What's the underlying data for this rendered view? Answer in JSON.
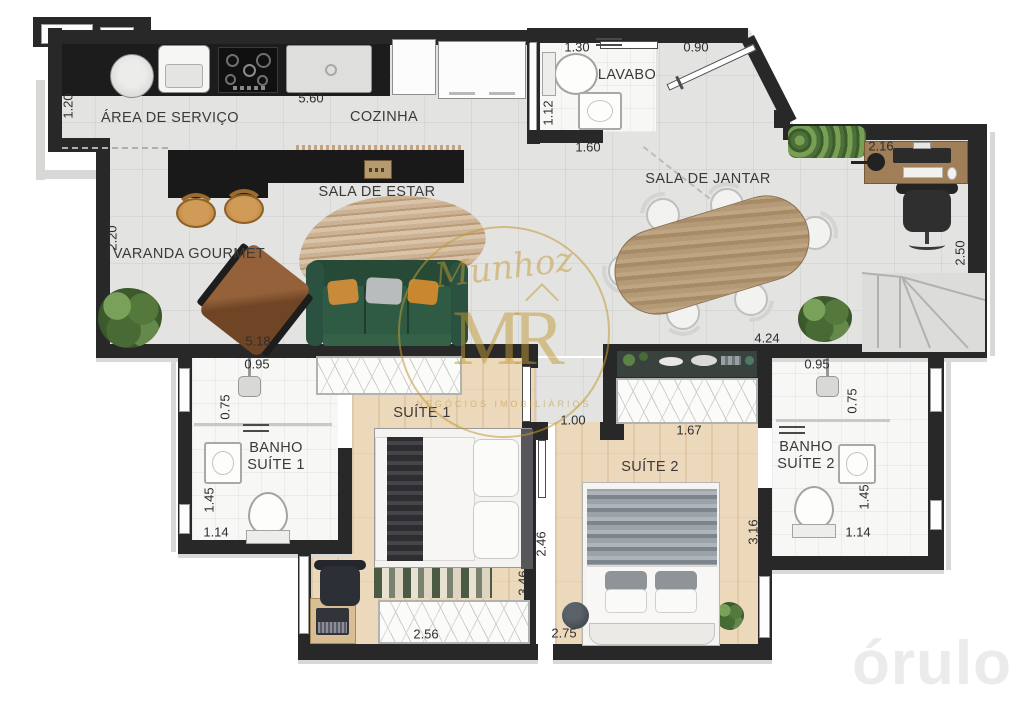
{
  "rooms": {
    "servico": "ÁREA DE SERVIÇO",
    "cozinha": "COZINHA",
    "lavabo": "LAVABO",
    "jantar": "SALA DE JANTAR",
    "estar": "SALA DE ESTAR",
    "varanda": "VARANDA GOURMET",
    "banho1": "BANHO\nSUÍTE 1",
    "suite1": "SUÍTE 1",
    "suite2": "SUÍTE 2",
    "banho2": "BANHO\nSUÍTE 2"
  },
  "dims": {
    "servico_left": "1.20",
    "cozinha_top": "5.60",
    "lavabo_top": "1.30",
    "entry_top": "0.90",
    "lavabo_left": "1.12",
    "lavabo_bottom": "1.60",
    "desk_top": "2.16",
    "living_right": "2.50",
    "varanda_left": "2.20",
    "varanda_bottom": "5.18",
    "jantar_bottom": "4.24",
    "banho1_top": "0.95",
    "banho1_shower": "0.75",
    "banho1_left": "1.45",
    "banho1_bottom": "1.14",
    "corridor": "1.00",
    "suite2_wardrobe": "1.67",
    "suite1_right": "3.46",
    "suite2_left": "2.46",
    "suite2_right": "3.16",
    "suite1_wardrobe": "2.56",
    "suite2_bottom": "2.75",
    "banho2_top": "0.95",
    "banho2_shower": "0.75",
    "banho2_right": "1.45",
    "banho2_bottom": "1.14"
  },
  "watermark": {
    "script": "Munhoz",
    "monogram": "MR",
    "subtext": "NEGÓCIOS IMOBILIÁRIOS"
  },
  "brand": {
    "logo": "órulo"
  },
  "colors": {
    "wall": "#282828",
    "floor_tile": "#e3e3e1",
    "floor_wood": "#ecd9bc",
    "bath_tile": "#f7f7f6",
    "counter": "#1c1c1c",
    "sofa_green": "#2f5a44",
    "cushion_orange": "#c98a3a",
    "stool_tan": "#c08845",
    "table_wood": "#a98e6e",
    "watermark_gold": "#c8a23c",
    "logo_gray": "#ebebeb"
  }
}
